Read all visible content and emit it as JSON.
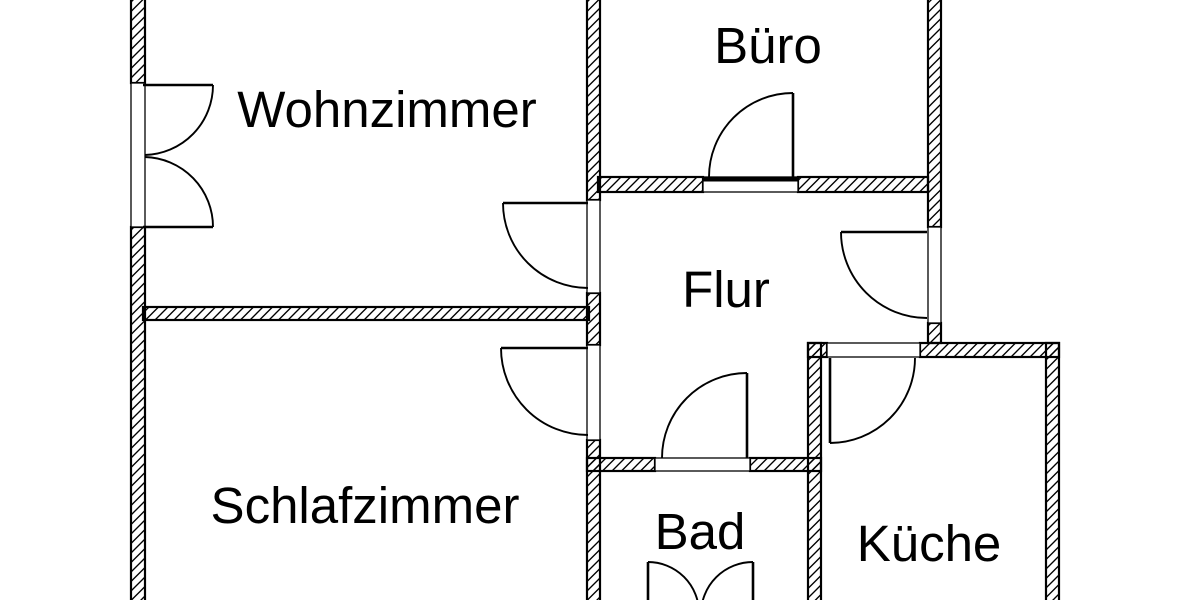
{
  "plan": {
    "kind": "apartment-floor-plan",
    "language": "de"
  },
  "colors": {
    "background": "#ffffff",
    "walls": "#000000",
    "text": "#000000"
  },
  "rooms": [
    {
      "id": "wohnzimmer",
      "label": "Wohnzimmer"
    },
    {
      "id": "buero",
      "label": "Büro"
    },
    {
      "id": "flur",
      "label": "Flur"
    },
    {
      "id": "schlafzimmer",
      "label": "Schlafzimmer"
    },
    {
      "id": "bad",
      "label": "Bad"
    },
    {
      "id": "kueche",
      "label": "Küche"
    }
  ],
  "doors": [
    {
      "id": "wohnzimmer-double-door",
      "type": "double-swing",
      "location": "left exterior wall of Wohnzimmer"
    },
    {
      "id": "wohnzimmer-flur-door",
      "type": "single-swing",
      "location": "between Flur and Wohnzimmer, opens into Wohnzimmer"
    },
    {
      "id": "buero-door",
      "type": "single-swing",
      "location": "between Flur and Büro, opens into Büro"
    },
    {
      "id": "entrance-door",
      "type": "single-swing",
      "location": "right wall of Flur, opens into Flur"
    },
    {
      "id": "schlafzimmer-flur-door",
      "type": "single-swing",
      "location": "between Flur and Schlafzimmer, opens into Schlafzimmer"
    },
    {
      "id": "kueche-door",
      "type": "single-swing",
      "location": "top wall of Küche, opens into Küche"
    },
    {
      "id": "bad-flur-door",
      "type": "single-swing",
      "location": "between Flur and Bad, opens into Flur"
    },
    {
      "id": "bad-double-door",
      "type": "double-swing",
      "location": "bottom wall of Bad (cropped at image edge)"
    }
  ]
}
